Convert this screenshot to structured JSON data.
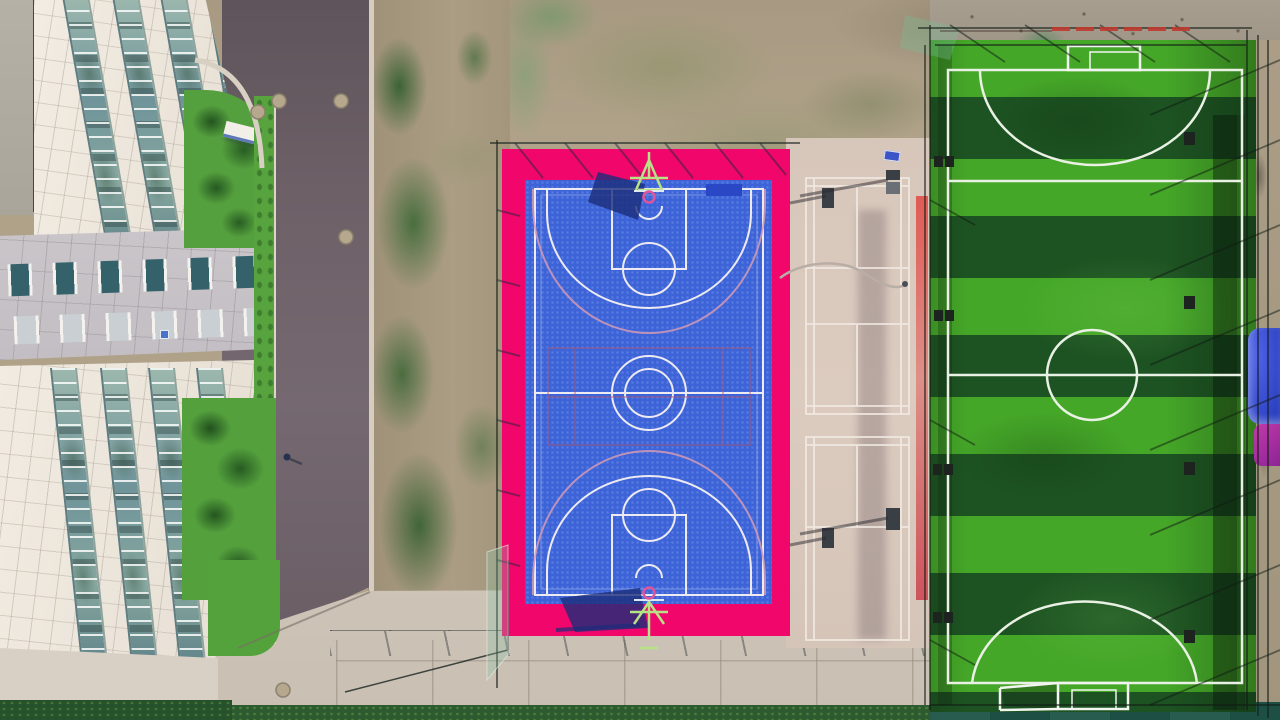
{
  "scene": {
    "type": "aerial-drone-photo",
    "description": "Top-down aerial view of a campus sports complex: white office building with vertical glass window strips on the left, a dark asphalt road, patchy dirt and grass, a blue basketball court with a bright pink surround and green hoop stands in the center, beige badminton courts with white lines, and a striped green artificial-turf soccer pitch with white markings and black netting fence on the right.",
    "objects": [
      {
        "label": "office-building"
      },
      {
        "label": "asphalt-road"
      },
      {
        "label": "manhole-covers",
        "count": 5
      },
      {
        "label": "pedestrian-with-bicycle"
      },
      {
        "label": "basketball-court"
      },
      {
        "label": "basketball-hoops",
        "count": 2
      },
      {
        "label": "badminton-courts",
        "count": 2
      },
      {
        "label": "soccer-field"
      },
      {
        "label": "soccer-goals",
        "count": 2
      },
      {
        "label": "turf-stripes",
        "count": 11
      },
      {
        "label": "perimeter-fence-netting"
      },
      {
        "label": "blue-and-purple-canopies"
      },
      {
        "label": "hedges-and-lawns"
      }
    ]
  },
  "colors": {
    "dirt_tan": "#b0a289",
    "bball_pink": "#f1066b",
    "bball_blue": "#3c63d8",
    "court_line": "#edeaf2",
    "overlay_pink": "#d49ab4",
    "overlay_red": "#b05570",
    "stand_green": "#b7e387",
    "ring_pink": "#e0559a",
    "shadow_navy": "#1c2d7a",
    "soccer_light": "#45a728",
    "soccer_dark": "#1d5322",
    "soccer_line": "#e9f0e4",
    "badminton_line": "#f2ece4",
    "fence_dark": "#22352a",
    "red_line": "#bf3a2e",
    "red_stripe": "#e15550",
    "umbrella_blue": "#3247cb",
    "umbrella_purple": "#b62f9e"
  }
}
